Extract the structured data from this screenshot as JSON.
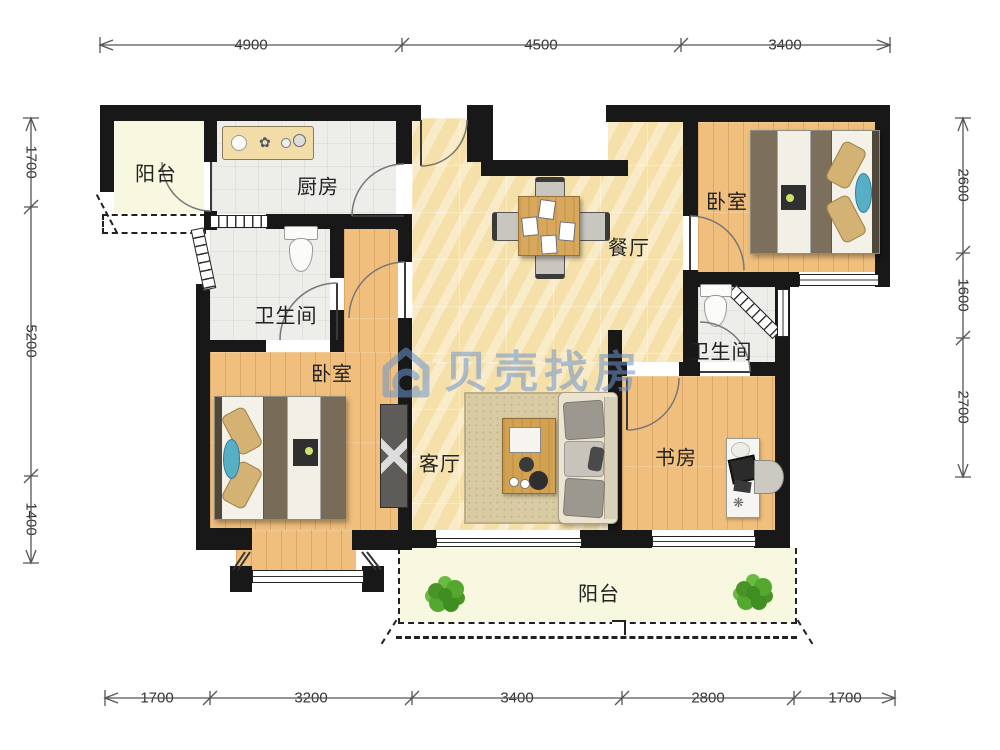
{
  "watermark": {
    "text": "贝壳找房",
    "color": "#6E95CC"
  },
  "rooms": {
    "balcony_top": {
      "label": "阳台"
    },
    "kitchen": {
      "label": "厨房"
    },
    "dining": {
      "label": "餐厅"
    },
    "bedroom_right": {
      "label": "卧室"
    },
    "bathroom_left": {
      "label": "卫生间"
    },
    "bedroom_left": {
      "label": "卧室"
    },
    "living": {
      "label": "客厅"
    },
    "bathroom_right": {
      "label": "卫生间"
    },
    "study": {
      "label": "书房"
    },
    "balcony_bottom": {
      "label": "阳台"
    }
  },
  "dimensions": {
    "top": [
      "4900",
      "4500",
      "3400"
    ],
    "bottom": [
      "1700",
      "3200",
      "3400",
      "2800",
      "1700"
    ],
    "left": [
      "1700",
      "5200",
      "1400"
    ],
    "right": [
      "2600",
      "1600",
      "2700"
    ]
  },
  "colors": {
    "wall": "#181818",
    "marble_floor": "#F6E3B0",
    "wood_floor": "#F0BF7D",
    "tile_floor": "#EDEDEA",
    "balcony_floor": "#F8F7E0",
    "watermark_blue": "#6E95CC",
    "duvet_brown": "#7A6E5A",
    "pillow_tan": "#D4B273",
    "pillow_blue": "#57AFC6",
    "table_wood": "#D8A75C",
    "plant_green": "#4A9427"
  }
}
